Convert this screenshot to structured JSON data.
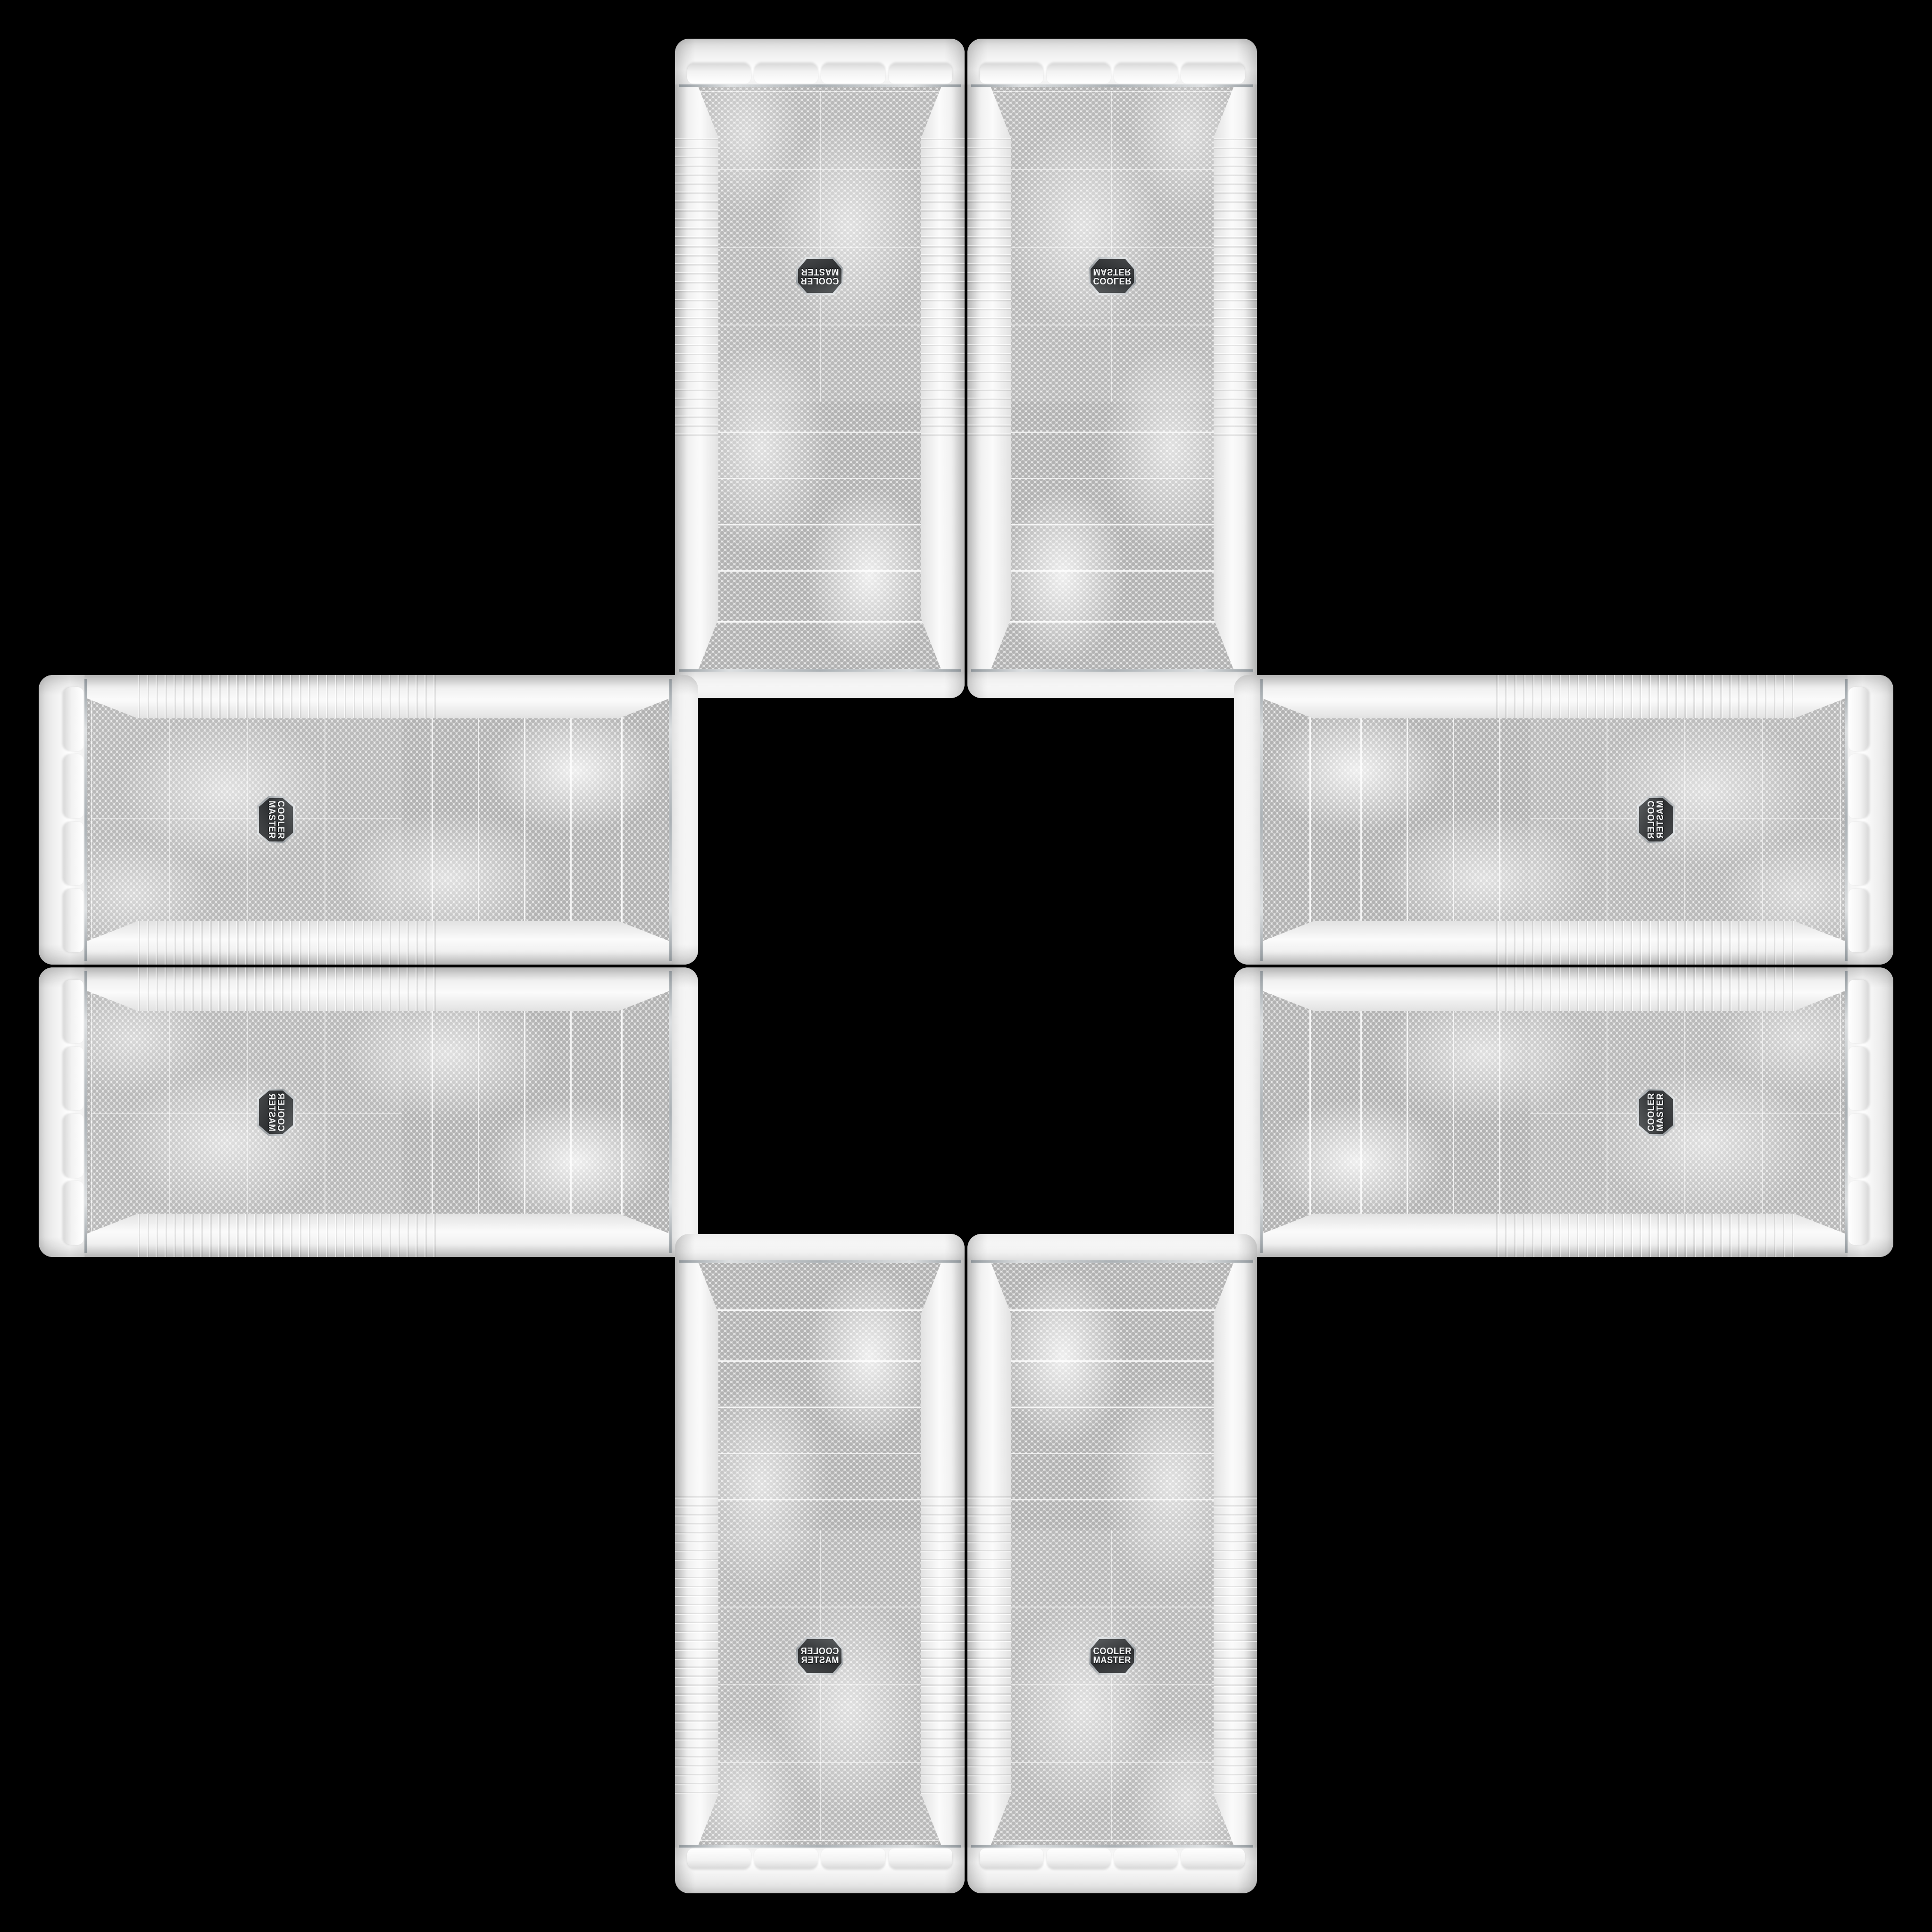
{
  "scene": {
    "background": "#000000",
    "description": "Eight identical white Cooler Master PC tower cases arranged in a cross / plus pattern (mirrored and rotated copies) on a black background"
  },
  "badge": {
    "line1": "COOLER",
    "line2": "MASTER",
    "body_color": "#313335",
    "rim_color": "#c7cbce",
    "text_color": "#f3f4f5"
  },
  "colors": {
    "case_body": "#f4f4f4",
    "mesh_background": "#e9e9e9",
    "mesh_dot": "#b2b2b2",
    "chrome_trim": "#abb1b5",
    "edge_shadow": "#c3c3c3"
  },
  "cases": [
    {
      "slot": "top-left",
      "orientation": "rot180"
    },
    {
      "slot": "top-right",
      "orientation": "mirror-y"
    },
    {
      "slot": "left-top",
      "orientation": "rot90"
    },
    {
      "slot": "right-top",
      "orientation": "transpose"
    },
    {
      "slot": "left-bottom",
      "orientation": "antitranspose"
    },
    {
      "slot": "right-bottom",
      "orientation": "rot270"
    },
    {
      "slot": "bottom-left",
      "orientation": "mirror-x"
    },
    {
      "slot": "bottom-right",
      "orientation": "identity"
    }
  ]
}
